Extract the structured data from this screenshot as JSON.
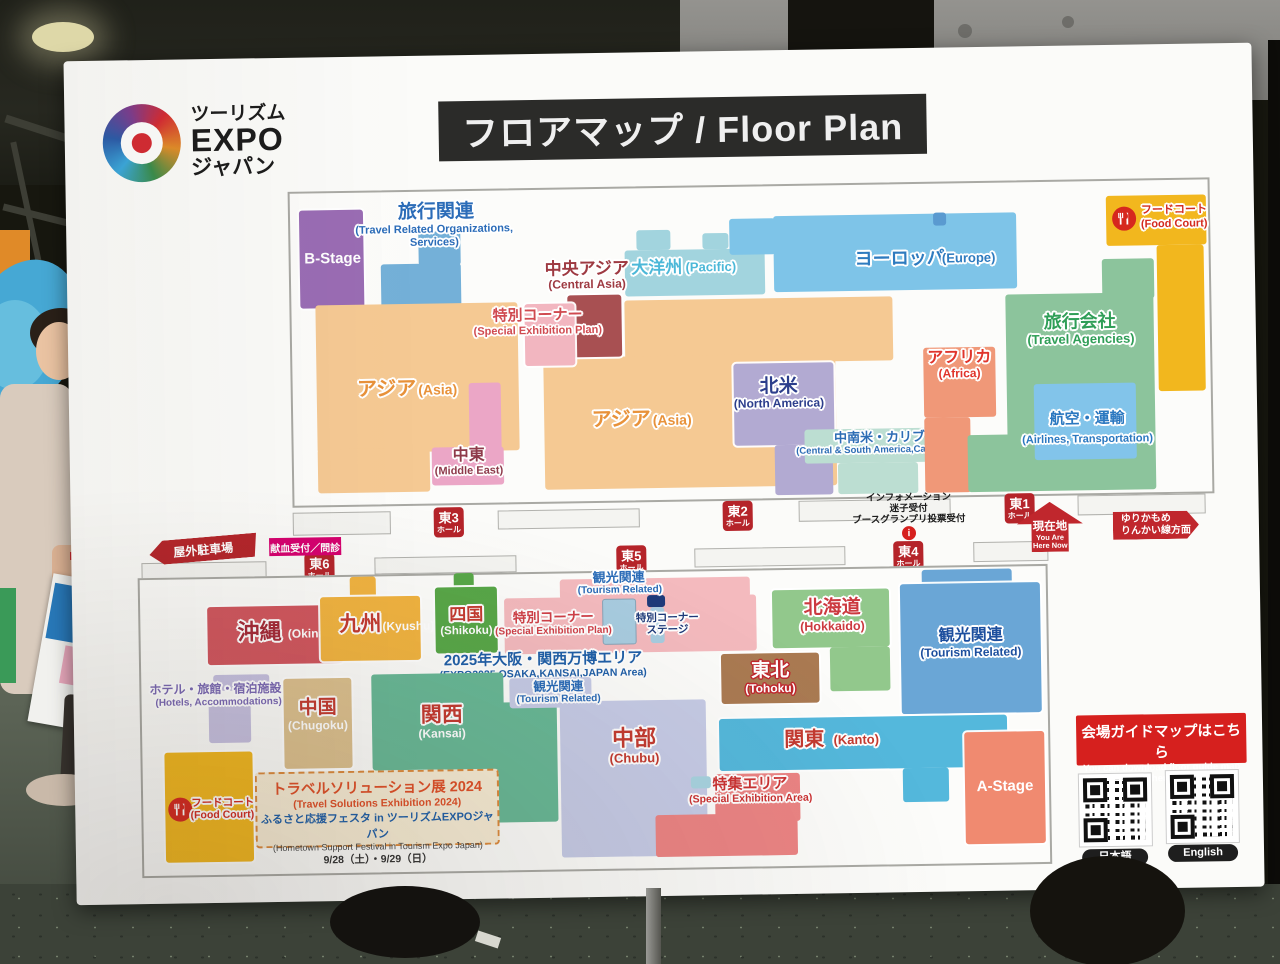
{
  "palette": {
    "board": "#fbfbf9",
    "hall_badge_red": "#b5242a",
    "magenta": "#d6006f",
    "banner_red": "#d6201e",
    "title_bar": "#2b2b29",
    "orange_asia": "#f5c993",
    "purple_bstage": "#9a6cb4",
    "blue_europe": "#7ec4e8",
    "green_agencies": "#8cc49c",
    "yellow_foodcourt": "#f2b71e",
    "pink_special": "#f4babe",
    "cyan_kanto": "#54b8dc"
  },
  "board": {
    "logo": {
      "t1": "ツーリズム",
      "t2": "EXPO",
      "t3": "ジャパン"
    },
    "title": "フロアマップ / Floor Plan",
    "upper": {
      "b_stage": "B-Stage",
      "travel_related": {
        "jp": "旅行関連",
        "en1": "(Travel Related Organizations,",
        "en2": "Services)"
      },
      "central_asia": {
        "jp": "中央アジア",
        "en": "(Central Asia)"
      },
      "special_corner": {
        "jp": "特別コーナー",
        "en": "(Special Exhibition Plan)"
      },
      "pacific": {
        "jp": "大洋州",
        "en": "(Pacific)"
      },
      "europe": {
        "jp": "ヨーロッパ",
        "en": "(Europe)"
      },
      "food_court": {
        "jp": "フードコート",
        "en": "(Food Court)"
      },
      "asia_left": {
        "jp": "アジア",
        "en": "(Asia)"
      },
      "asia_center": {
        "jp": "アジア",
        "en": "(Asia)"
      },
      "middle_east": {
        "jp": "中東",
        "en": "(Middle East)"
      },
      "north_america": {
        "jp": "北米",
        "en": "(North America)"
      },
      "africa": {
        "jp": "アフリカ",
        "en": "(Africa)"
      },
      "travel_agencies": {
        "jp": "旅行会社",
        "en": "(Travel Agencies)"
      },
      "csa_caribbean": {
        "jp": "中南米・カリブ",
        "en": "(Central & South America,Caribbean)"
      },
      "airlines": {
        "jp": "航空・運輸",
        "en": "(Airlines, Transportation)"
      }
    },
    "halls": {
      "e1": {
        "n": "東1",
        "s": "ホール"
      },
      "e2": {
        "n": "東2",
        "s": "ホール"
      },
      "e3": {
        "n": "東3",
        "s": "ホール"
      },
      "e4": {
        "n": "東4",
        "s": "ホール"
      },
      "e5": {
        "n": "東5",
        "s": "ホール"
      },
      "e6": {
        "n": "東6",
        "s": "ホール"
      }
    },
    "annot": {
      "parking": "屋外駐車場",
      "blood": "献血受付／問診",
      "info1": "インフォメーション",
      "info2": "迷子受付",
      "info3": "ブースグランプリ投票受付",
      "info_i": "i",
      "here_jp": "現在地",
      "here_en1": "You Are",
      "here_en2": "Here Now",
      "train1": "ゆりかもめ",
      "train2": "りんかい線方面"
    },
    "lower": {
      "okinawa": {
        "jp": "沖縄",
        "en": "(Okinawa)"
      },
      "kyushu": {
        "jp": "九州",
        "en": "(Kyushu)"
      },
      "shikoku": {
        "jp": "四国",
        "en": "(Shikoku)"
      },
      "special_corner": {
        "jp": "特別コーナー",
        "en": "(Special Exhibition Plan)"
      },
      "tourism_stage": {
        "jp": "観光関連",
        "en": "(Tourism Related)"
      },
      "stage": {
        "l1": "特別コーナー",
        "l2": "ステージ"
      },
      "hokkaido": {
        "jp": "北海道",
        "en": "(Hokkaido)"
      },
      "tourism_right": {
        "jp": "観光関連",
        "en": "(Tourism Related)"
      },
      "expo2025": {
        "jp": "2025年大阪・関西万博エリア",
        "en": "(EXPO2025 OSAKA,KANSAI,JAPAN Area)"
      },
      "hotels": {
        "jp": "ホテル・旅館・宿泊施設",
        "en": "(Hotels, Accommodations)"
      },
      "chugoku": {
        "jp": "中国",
        "en": "(Chugoku)"
      },
      "kansai": {
        "jp": "関西",
        "en": "(Kansai)"
      },
      "tourism_center": {
        "jp": "観光関連",
        "en": "(Tourism Related)"
      },
      "tohoku": {
        "jp": "東北",
        "en": "(Tohoku)"
      },
      "chubu": {
        "jp": "中部",
        "en": "(Chubu)"
      },
      "kanto": {
        "jp": "関東",
        "en": "(Kanto)"
      },
      "special_area": {
        "jp": "特集エリア",
        "en": "(Special Exhibition Area)"
      },
      "a_stage": "A-Stage",
      "food_court": {
        "jp": "フードコート",
        "en": "(Food Court)"
      },
      "travel_box": {
        "t1": "トラベルソリューション展 2024",
        "t2": "(Travel Solutions Exhibition 2024)",
        "t3": "ふるさと応援フェスタ in ツーリズムEXPOジャパン",
        "t4": "(Hometown Support Festival in Tourism Expo Japan)",
        "t5": "9/28（土）・9/29（日）"
      },
      "guide": {
        "jp": "会場ガイドマップはこちら",
        "en": "You can download floor guide map here",
        "qr1": "日本語",
        "qr2": "English"
      }
    }
  }
}
